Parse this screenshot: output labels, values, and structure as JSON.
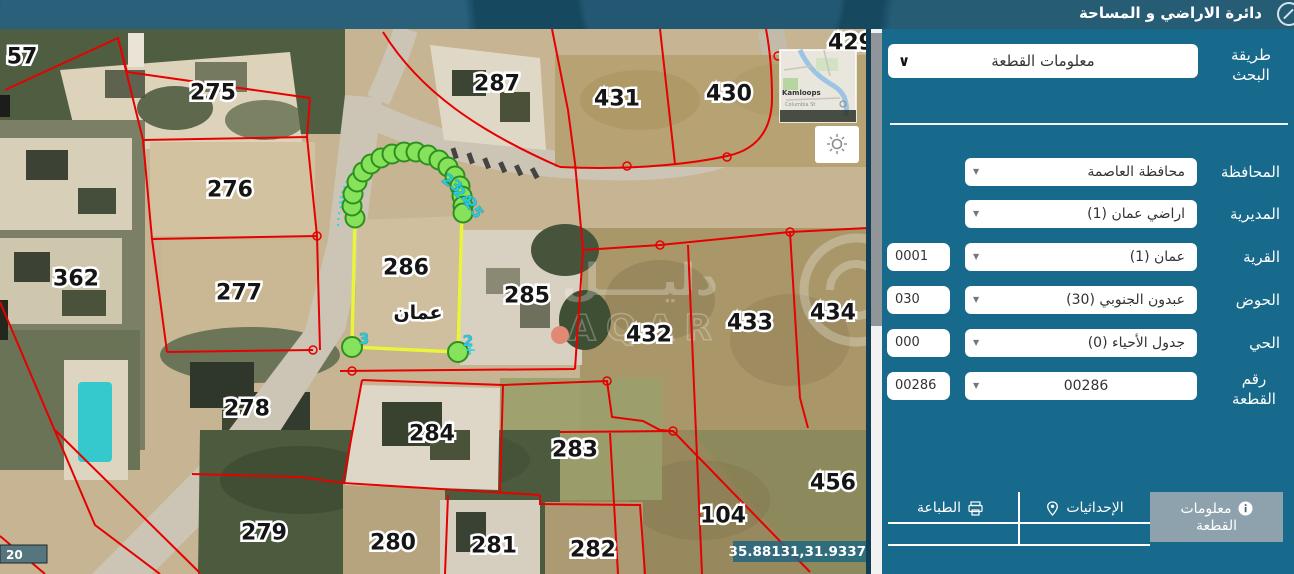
{
  "header": {
    "title": "دائرة الاراضي و المساحة"
  },
  "panel": {
    "search_method": {
      "label": "طريقة البحث",
      "value": "معلومات القطعة"
    },
    "fields": [
      {
        "label": "المحافظة",
        "value": "محافظة العاصمة",
        "code": ""
      },
      {
        "label": "المديرية",
        "value": "اراضي عمان (1)",
        "code": ""
      },
      {
        "label": "القرية",
        "value": "عمان (1)",
        "code": "0001"
      },
      {
        "label": "الحوض",
        "value": "عبدون الجنوبي (30)",
        "code": "030"
      },
      {
        "label": "الحي",
        "value": "جدول الأحياء (0)",
        "code": "000"
      },
      {
        "label": "رقم القطعة",
        "value": "00286",
        "code": "00286"
      }
    ],
    "tabs": [
      {
        "label": "الطباعة",
        "icon": "printer-icon"
      },
      {
        "label": "الإحداثيات",
        "icon": "location-pin-icon"
      },
      {
        "label": "معلومات القطعة",
        "icon": "info-icon",
        "active": true
      }
    ]
  },
  "map": {
    "coordinates": "35.88131,31.93379",
    "scale_text": "20",
    "minimap": {
      "city": "Kamloops",
      "street": "Columbia St"
    },
    "watermark": {
      "arabic": "دليــــل",
      "latin": "AQAR"
    },
    "selected_parcel": {
      "number": "286",
      "name": "عمان"
    },
    "corner_numbers": [
      "3",
      "2"
    ],
    "arc_numbers": [
      "23",
      "24",
      "25"
    ],
    "parcels": [
      {
        "label": "57"
      },
      {
        "label": "275"
      },
      {
        "label": "287"
      },
      {
        "label": "431"
      },
      {
        "label": "430"
      },
      {
        "label": "429"
      },
      {
        "label": "276"
      },
      {
        "label": "362"
      },
      {
        "label": "277"
      },
      {
        "label": "285"
      },
      {
        "label": "432"
      },
      {
        "label": "433"
      },
      {
        "label": "434"
      },
      {
        "label": "278"
      },
      {
        "label": "284"
      },
      {
        "label": "283"
      },
      {
        "label": "456"
      },
      {
        "label": "104"
      },
      {
        "label": "279"
      },
      {
        "label": "280"
      },
      {
        "label": "281"
      },
      {
        "label": "282"
      }
    ],
    "colors": {
      "parcel_line": "#e60000",
      "highlight_line": "#e8f53a",
      "vertex_fill": "#86e25b",
      "vertex_stroke": "#2e8f1f",
      "arc_cyan": "#2fd3e4",
      "panel_teal": "#176a8c",
      "header_navy": "#164860"
    }
  }
}
